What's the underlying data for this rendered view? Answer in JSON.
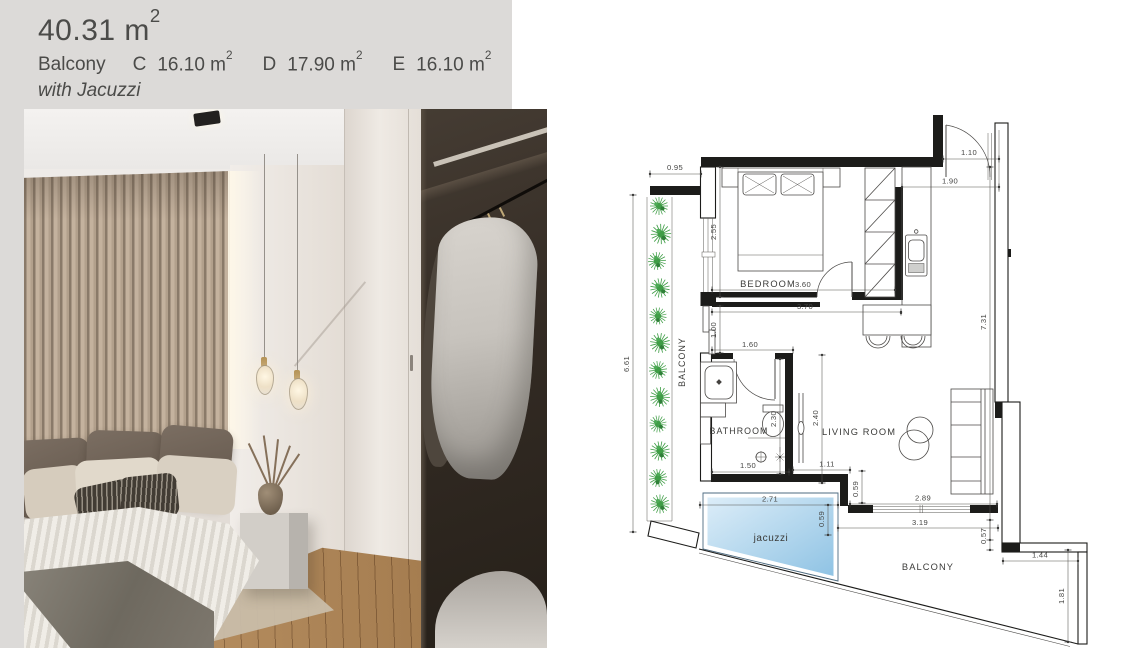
{
  "header": {
    "area_value": "40.31 m",
    "area_sup": "2",
    "balcony_label": "Balcony",
    "units": [
      {
        "key": "C",
        "value": "16.10 m",
        "sup": "2"
      },
      {
        "key": "D",
        "value": "17.90 m",
        "sup": "2"
      },
      {
        "key": "E",
        "value": "16.10 m",
        "sup": "2"
      }
    ],
    "subtitle": "with Jacuzzi"
  },
  "plan": {
    "rooms": {
      "bedroom": "BEDROOM",
      "bathroom": "BATHROOM",
      "living_room": "LIVING ROOM",
      "balcony_side": "BALCONY",
      "balcony_bottom": "BALCONY",
      "jacuzzi": "jacuzzi"
    },
    "dims": {
      "d095": "0.95",
      "d661": "6.61",
      "d255": "2.55",
      "d100": "1.00",
      "d360": "3.60",
      "d370": "3.70",
      "d160": "1.60",
      "d110": "1.10",
      "d190": "1.90",
      "d731": "7.31",
      "d230": "2.30",
      "d240": "2.40",
      "d150": "1.50",
      "d111": "1.11",
      "d059a": "0.59",
      "d289": "2.89",
      "d319": "3.19",
      "d271": "2.71",
      "d059b": "0.59",
      "d057": "0.57",
      "d144": "1.44",
      "d181": "1.81"
    },
    "colors": {
      "gray_panel": "#dcdad8",
      "wall": "#1c1c1a",
      "dimension": "#55534f",
      "plant_green": "#3f9d46",
      "jacuzzi_light": "#dcedf8",
      "jacuzzi_dark": "#8fc3e4"
    }
  }
}
